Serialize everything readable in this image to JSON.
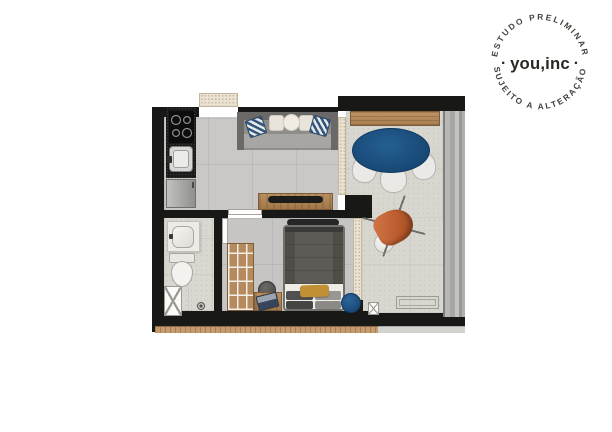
{
  "stamp": {
    "arc_top": "ESTUDO PRELIMINAR",
    "arc_bottom": "SUJEITO A ALTERAÇÃO",
    "brand": "you,inc",
    "dot": "·",
    "text_color": "#3b3834"
  },
  "floorplan": {
    "type": "studio-apartment-floor-plan",
    "rooms": [
      {
        "name": "kitchen",
        "furniture": [
          "cooktop",
          "sink",
          "fridge-cabinet",
          "black-countertop"
        ]
      },
      {
        "name": "living-room",
        "furniture": [
          "sofa",
          "chevron-pillows",
          "round-cushions",
          "tv-console",
          "tv"
        ]
      },
      {
        "name": "bedroom",
        "furniture": [
          "double-bed",
          "wardrobe",
          "desk",
          "laptop",
          "stool",
          "blue-pouf",
          "mustard-pillow",
          "tv"
        ]
      },
      {
        "name": "bathroom",
        "furniture": [
          "washbasin-counter",
          "toilet",
          "shower-shaft",
          "drain"
        ]
      },
      {
        "name": "balcony",
        "furniture": [
          "wood-bench",
          "oval-dining-table",
          "dining-chairs",
          "butterfly-armchair",
          "round-side-table",
          "floor-detail"
        ]
      }
    ],
    "palette": {
      "wall": "#181817",
      "living_floor": "#c9c8c6",
      "bedroom_floor": "#c6c5c3",
      "balcony_floor": "#d7d6cf",
      "bathroom_floor": "#d9d7d0",
      "wood": "#b1855a",
      "table_blue": "#1d4f80",
      "pillow_blue": "#31567d",
      "armchair_orange": "#c2653a",
      "pillow_mustard": "#bf9036",
      "door_beige": "#eae3d5",
      "brick_edge": "#c59a6c",
      "countertop": "#1b1b1b"
    }
  }
}
